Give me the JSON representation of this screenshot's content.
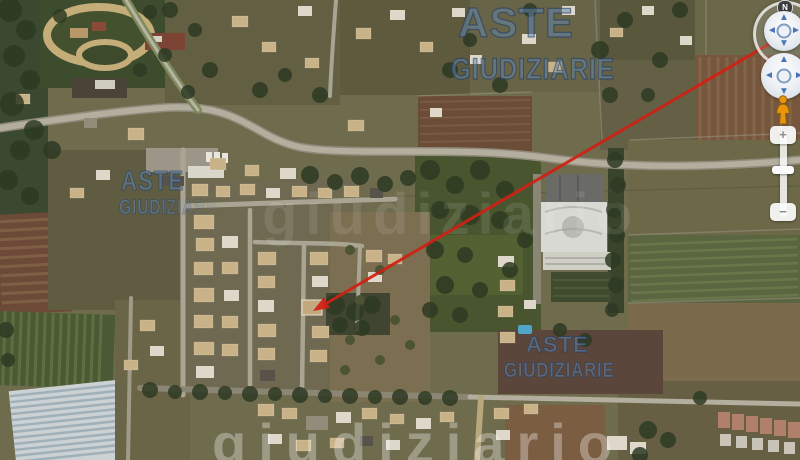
{
  "view": {
    "type": "satellite-map",
    "description": "Aerial satellite view of a residential area with fields and greenhouses, judicial-auction watermarks and a red arrow marking a property"
  },
  "brand_watermark": {
    "line1": "ASTE",
    "line2": "GIUDIZIARIE",
    "instances": [
      "top-center",
      "left-middle",
      "bottom-center"
    ]
  },
  "faint_watermark": {
    "text": "giudiziario"
  },
  "navigation": {
    "north_label": "N",
    "look": {
      "up": "▲",
      "down": "▼",
      "left": "◄",
      "right": "►"
    },
    "move": {
      "up": "▲",
      "down": "▼",
      "left": "◄",
      "right": "►"
    },
    "zoom": {
      "in": "+",
      "out": "−"
    }
  },
  "colors": {
    "pointer_red": "#cf2114",
    "watermark_blue": "#5a82af",
    "control_arrow_blue": "#4a74b8",
    "pegman_orange": "#e8950c"
  }
}
